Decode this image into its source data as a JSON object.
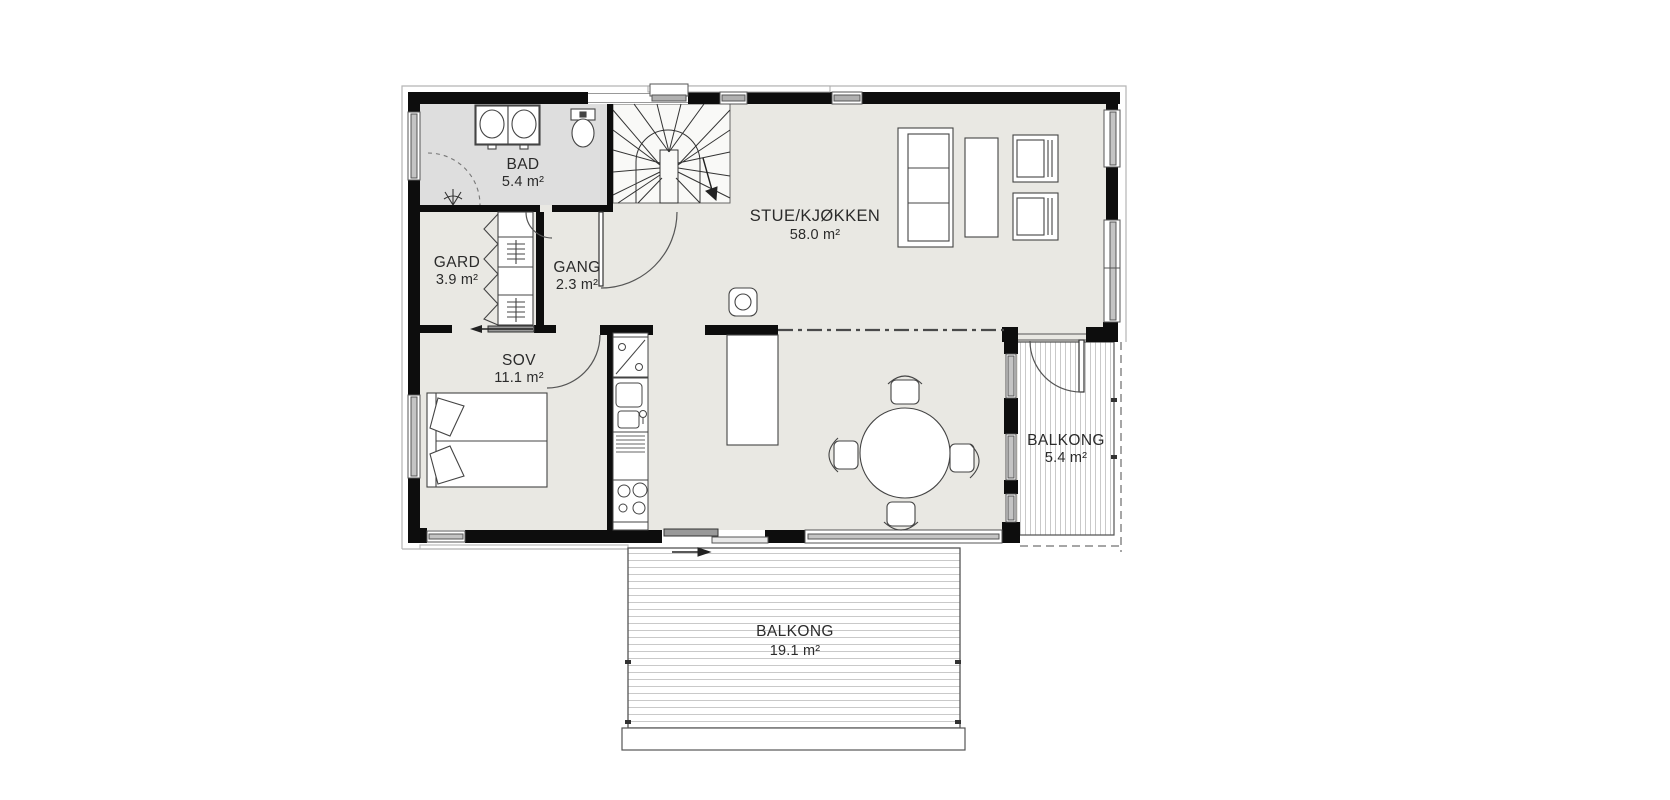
{
  "plan": {
    "title": "First floor plan",
    "rooms": [
      {
        "name": "BAD",
        "area": "5.4 m²"
      },
      {
        "name": "GARD",
        "area": "3.9 m²"
      },
      {
        "name": "GANG",
        "area": "2.3 m²"
      },
      {
        "name": "SOV",
        "area": "11.1 m²"
      },
      {
        "name": "STUE/KJØKKEN",
        "area": "58.0 m²"
      },
      {
        "name": "BALKONG",
        "area": "5.4 m²"
      },
      {
        "name": "BALKONG",
        "area": "19.1 m²"
      }
    ],
    "colors": {
      "wall": "#0d0d0d",
      "floor": "#e9e8e3",
      "bad_floor": "#dedede",
      "stair_floor": "#f9f9f7",
      "glazing": "#c4c4c4",
      "hatch_line": "#c9c9c9",
      "fixture_line": "#444444",
      "door_line": "#555555"
    }
  }
}
